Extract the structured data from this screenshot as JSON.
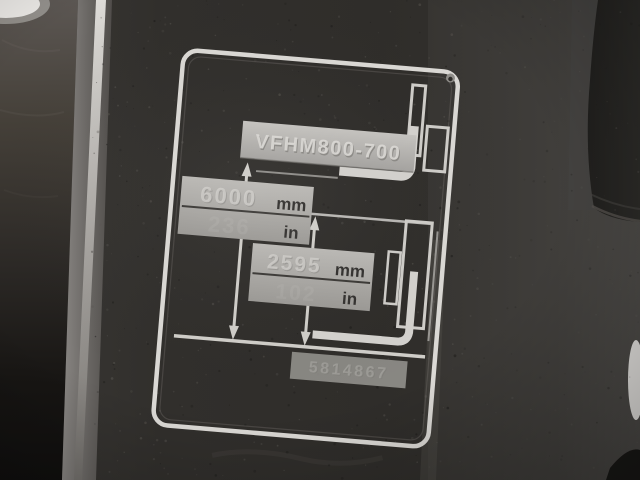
{
  "scene": {
    "type": "photograph",
    "subject": "Etched forklift mast lift-height specification plate on a dark metal panel",
    "colors": {
      "panel_dark": "#302e2b",
      "etch_silver": "#d9d7d3",
      "stamp_plate_light": "#b8b6b2",
      "deep_shadow": "#141311",
      "glare_white": "#edebe8"
    }
  },
  "plate": {
    "model_code": "VFHM800-700",
    "dim_total": {
      "value_mm": "6000",
      "unit_mm": "mm",
      "value_in": "236",
      "unit_in": "in"
    },
    "dim_free": {
      "value_mm": "2595",
      "unit_mm": "mm",
      "value_in": "102",
      "unit_in": "in"
    },
    "part_number": "5814867"
  }
}
